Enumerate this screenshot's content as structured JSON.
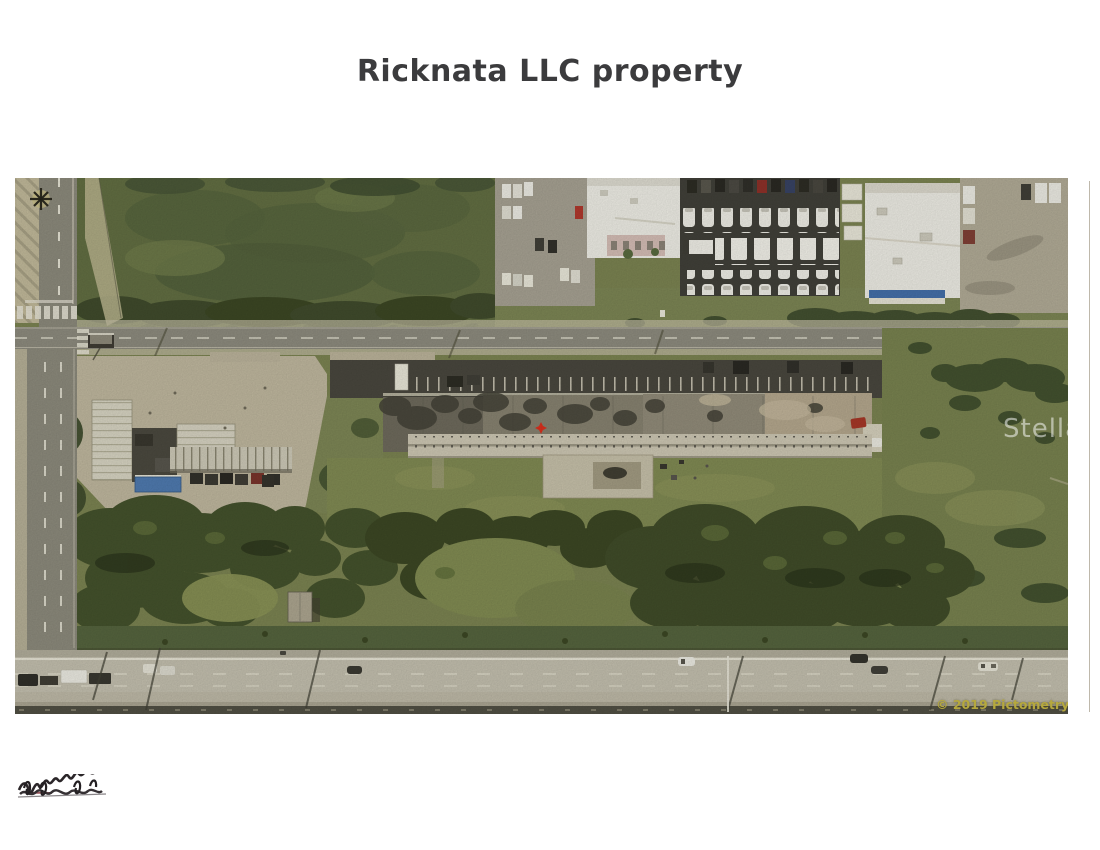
{
  "page": {
    "title": "Ricknata LLC property"
  },
  "photo": {
    "watermark_text": "StellarMLS",
    "copyright_text": "© 2019 Pictometry"
  },
  "colors": {
    "title": "#3b3b3d",
    "watermark": "rgba(255,255,255,0.52)",
    "copyright": "#b5a83e",
    "marker_red": "#dd2b19",
    "roof_blue": "#3f6cab",
    "grass": "#79814f",
    "highway_concrete": "#c5c0b0",
    "dark_asphalt": "#44423a",
    "tan_lot": "#c0b8a0"
  },
  "marks": {
    "compass_icon": "north-compass-star",
    "scribble": "scribbled-out-handwriting",
    "scan_artifact": "vertical-scan-line"
  }
}
